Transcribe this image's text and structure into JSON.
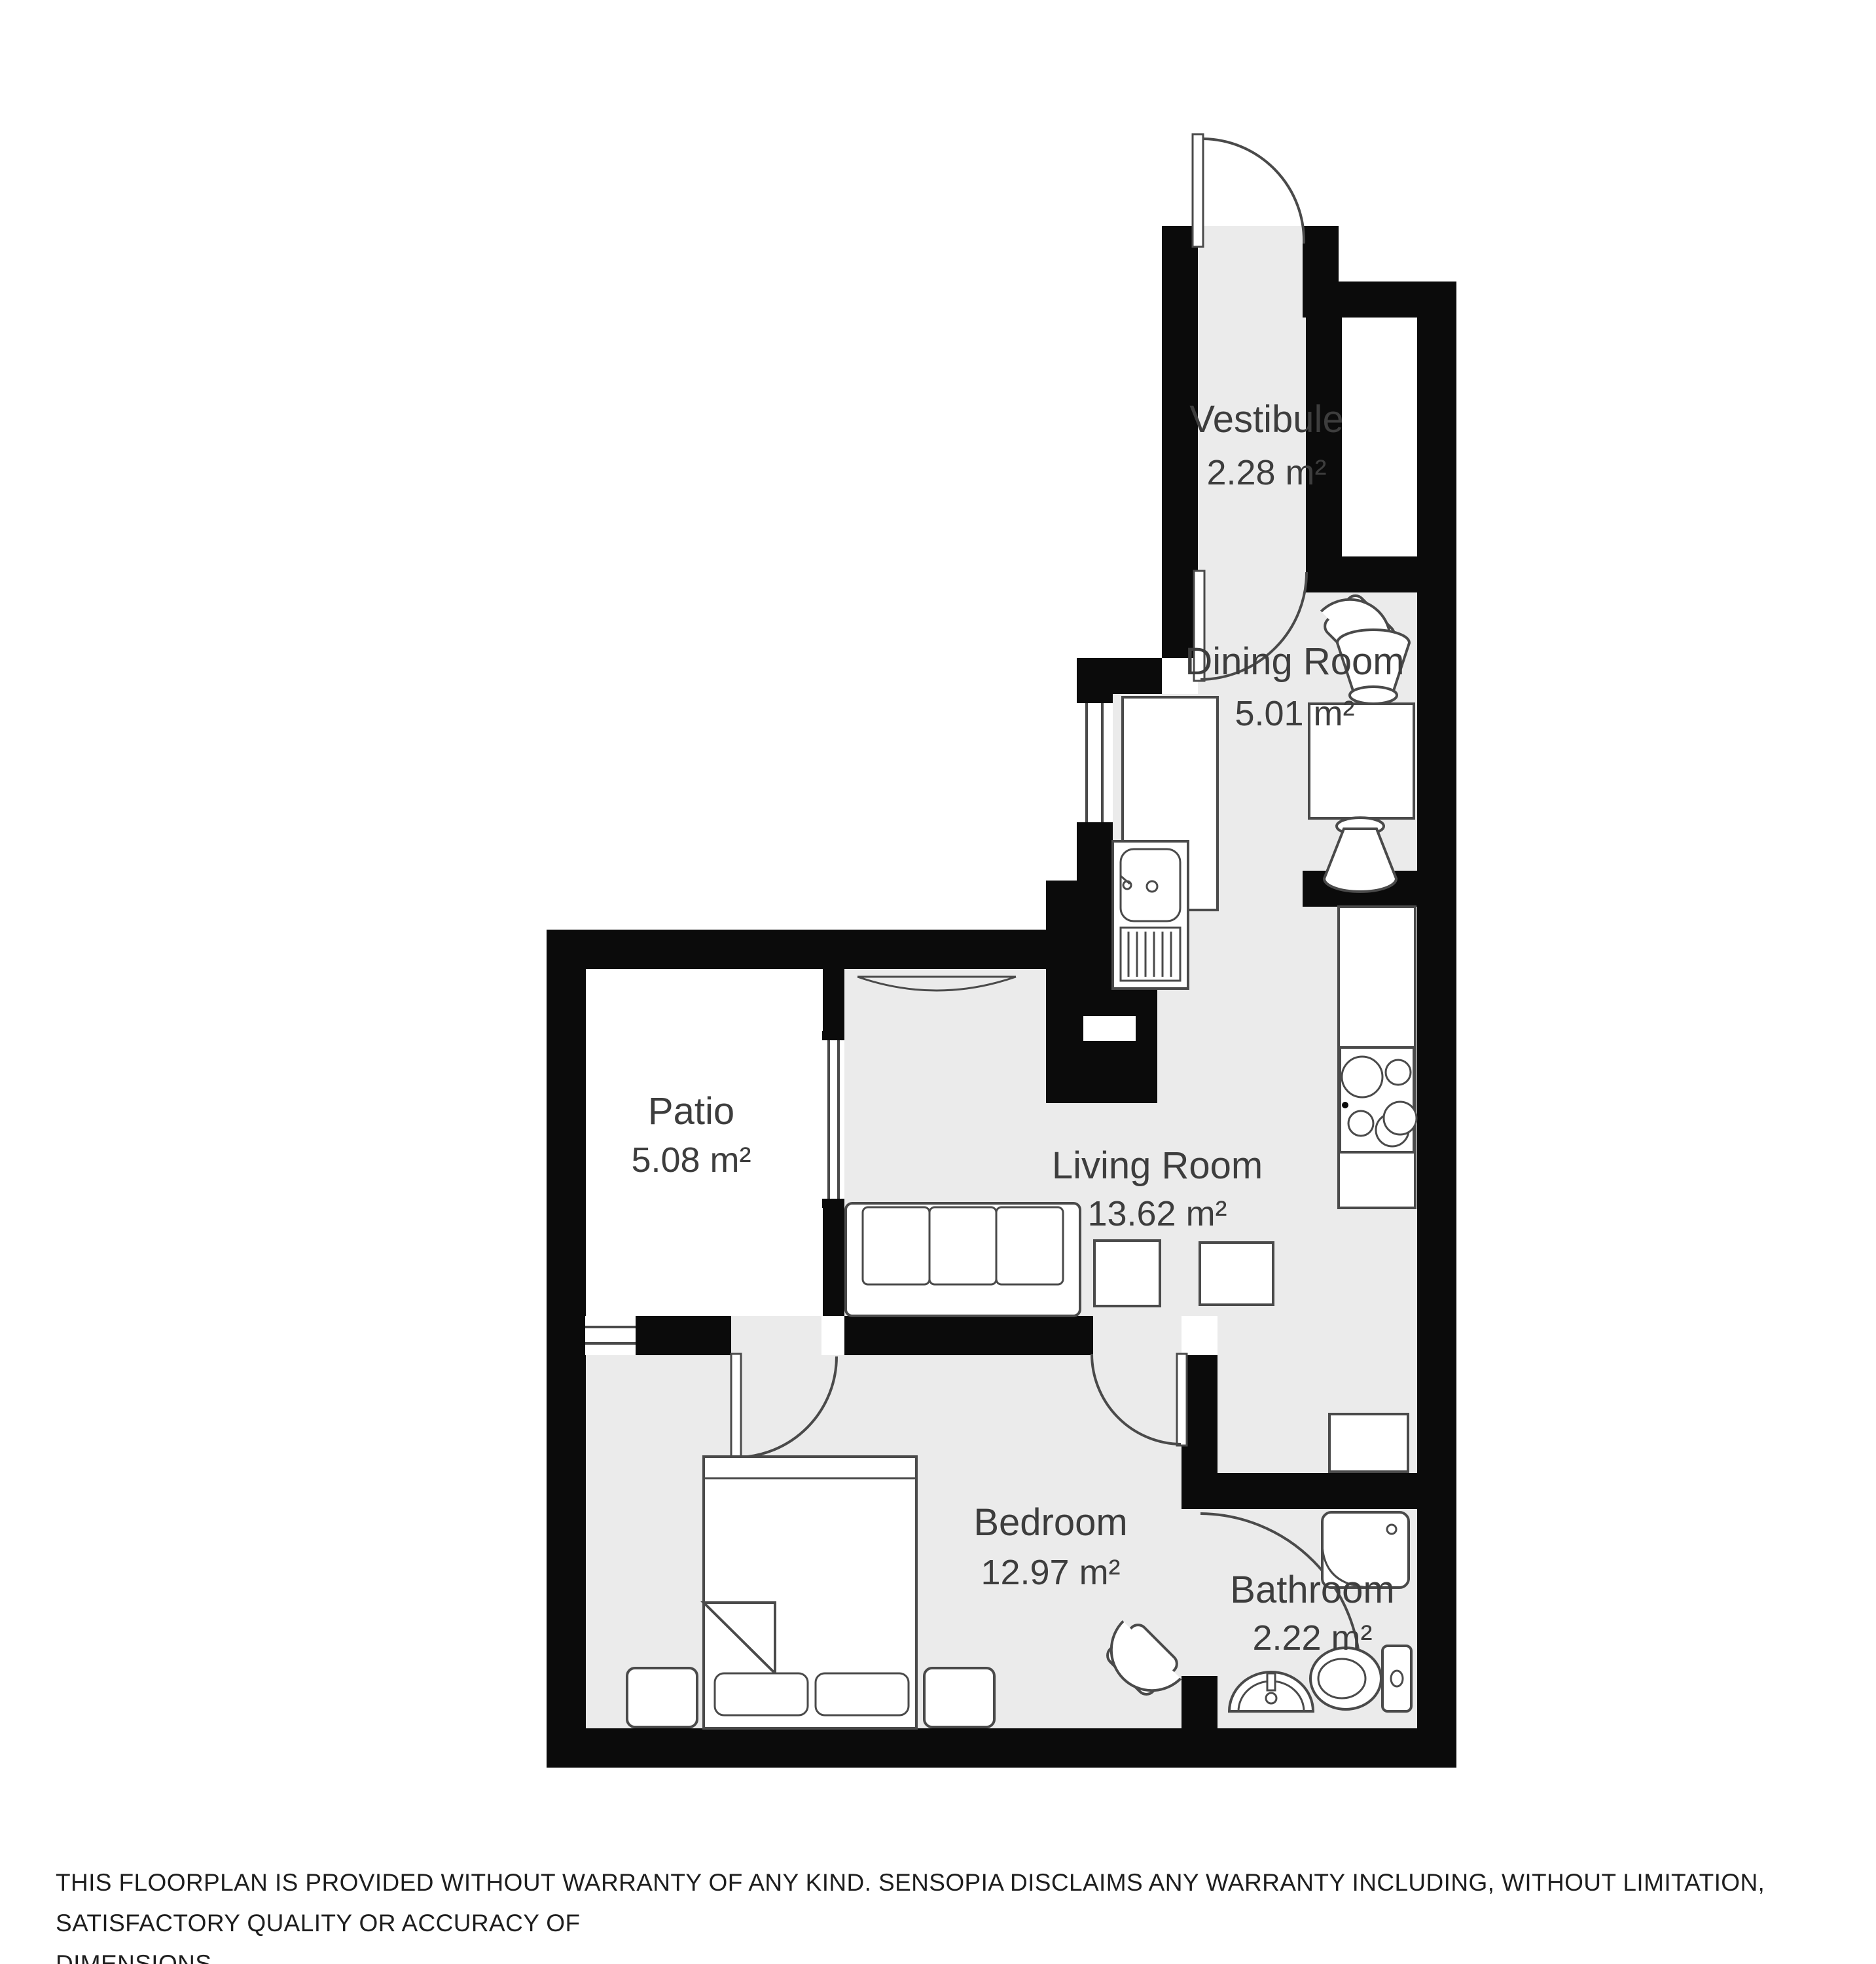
{
  "rooms": [
    {
      "id": "vestibule",
      "name": "Vestibule",
      "area": "2.28 m²"
    },
    {
      "id": "dining-room",
      "name": "Dining Room",
      "area": "5.01 m²"
    },
    {
      "id": "living-room",
      "name": "Living Room",
      "area": "13.62 m²"
    },
    {
      "id": "patio",
      "name": "Patio",
      "area": "5.08 m²"
    },
    {
      "id": "bedroom",
      "name": "Bedroom",
      "area": "12.97 m²"
    },
    {
      "id": "bathroom",
      "name": "Bathroom",
      "area": "2.22 m²"
    }
  ],
  "furniture_icons": [
    "entry-door",
    "interior-door",
    "dining-armchair",
    "dining-table",
    "dining-chair",
    "sideboard-counter",
    "kitchen-sink",
    "kitchen-counter",
    "stove",
    "window",
    "sofa",
    "side-table",
    "cabinet",
    "double-bed",
    "pillow",
    "nightstand",
    "bedroom-armchair",
    "washing-machine",
    "shower",
    "bathroom-sink",
    "toilet"
  ],
  "disclaimer": {
    "line1": "THIS FLOORPLAN IS PROVIDED WITHOUT WARRANTY OF ANY KIND. SENSOPIA DISCLAIMS ANY WARRANTY INCLUDING, WITHOUT LIMITATION, SATISFACTORY QUALITY OR ACCURACY OF",
    "line2": "DIMENSIONS."
  },
  "colors": {
    "wall": "#0b0b0b",
    "floor": "#ebebeb",
    "patio_floor": "#ffffff",
    "furniture_outline": "#4a4a4a",
    "label": "#3d3d3d",
    "background": "#ffffff"
  }
}
